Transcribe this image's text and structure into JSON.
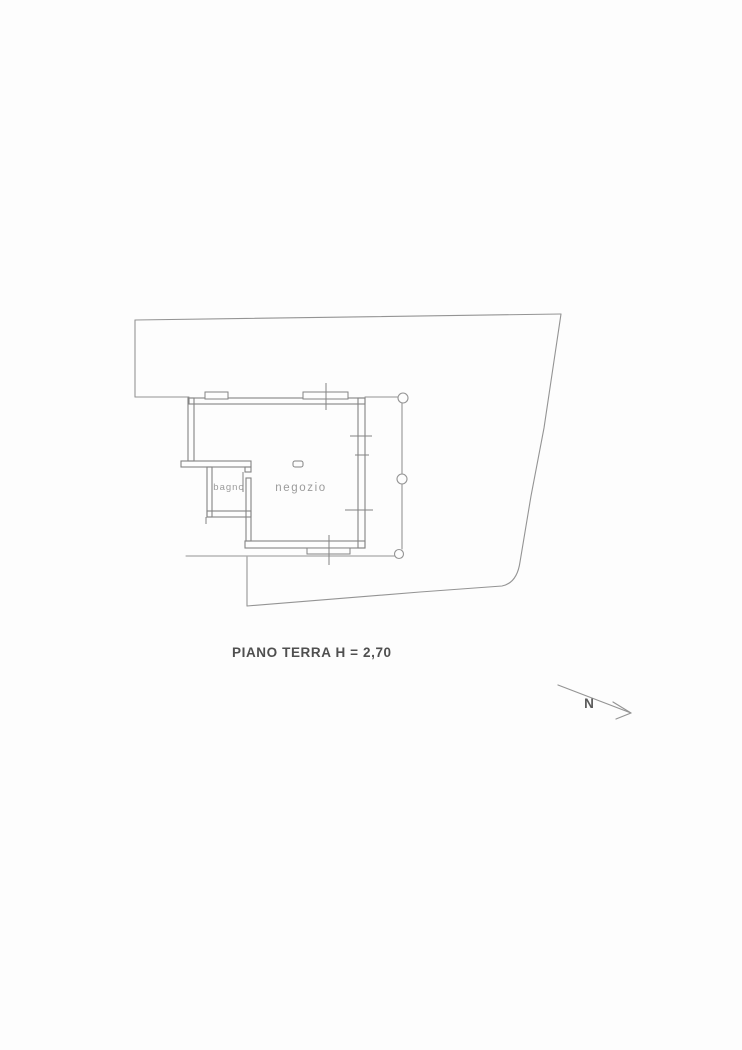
{
  "document": {
    "kind": "scanned floor plan drawing",
    "caption": "PIANO TERRA H = 2,70",
    "floor_height": "2,70",
    "compass_label": "N"
  },
  "plan": {
    "rooms": [
      {
        "id": "bagno",
        "label": "bagno"
      },
      {
        "id": "negozio",
        "label": "negozio"
      }
    ],
    "column_count": 3
  },
  "icons": {
    "north_arrow": "north-arrow-icon"
  },
  "colors": {
    "background": "#fdfdfd",
    "boundary_line": "#949494",
    "wall_line": "#848484",
    "room_label": "#9b9b9b",
    "caption_text": "#4f4f4f",
    "north_text": "#5a5a5a"
  }
}
